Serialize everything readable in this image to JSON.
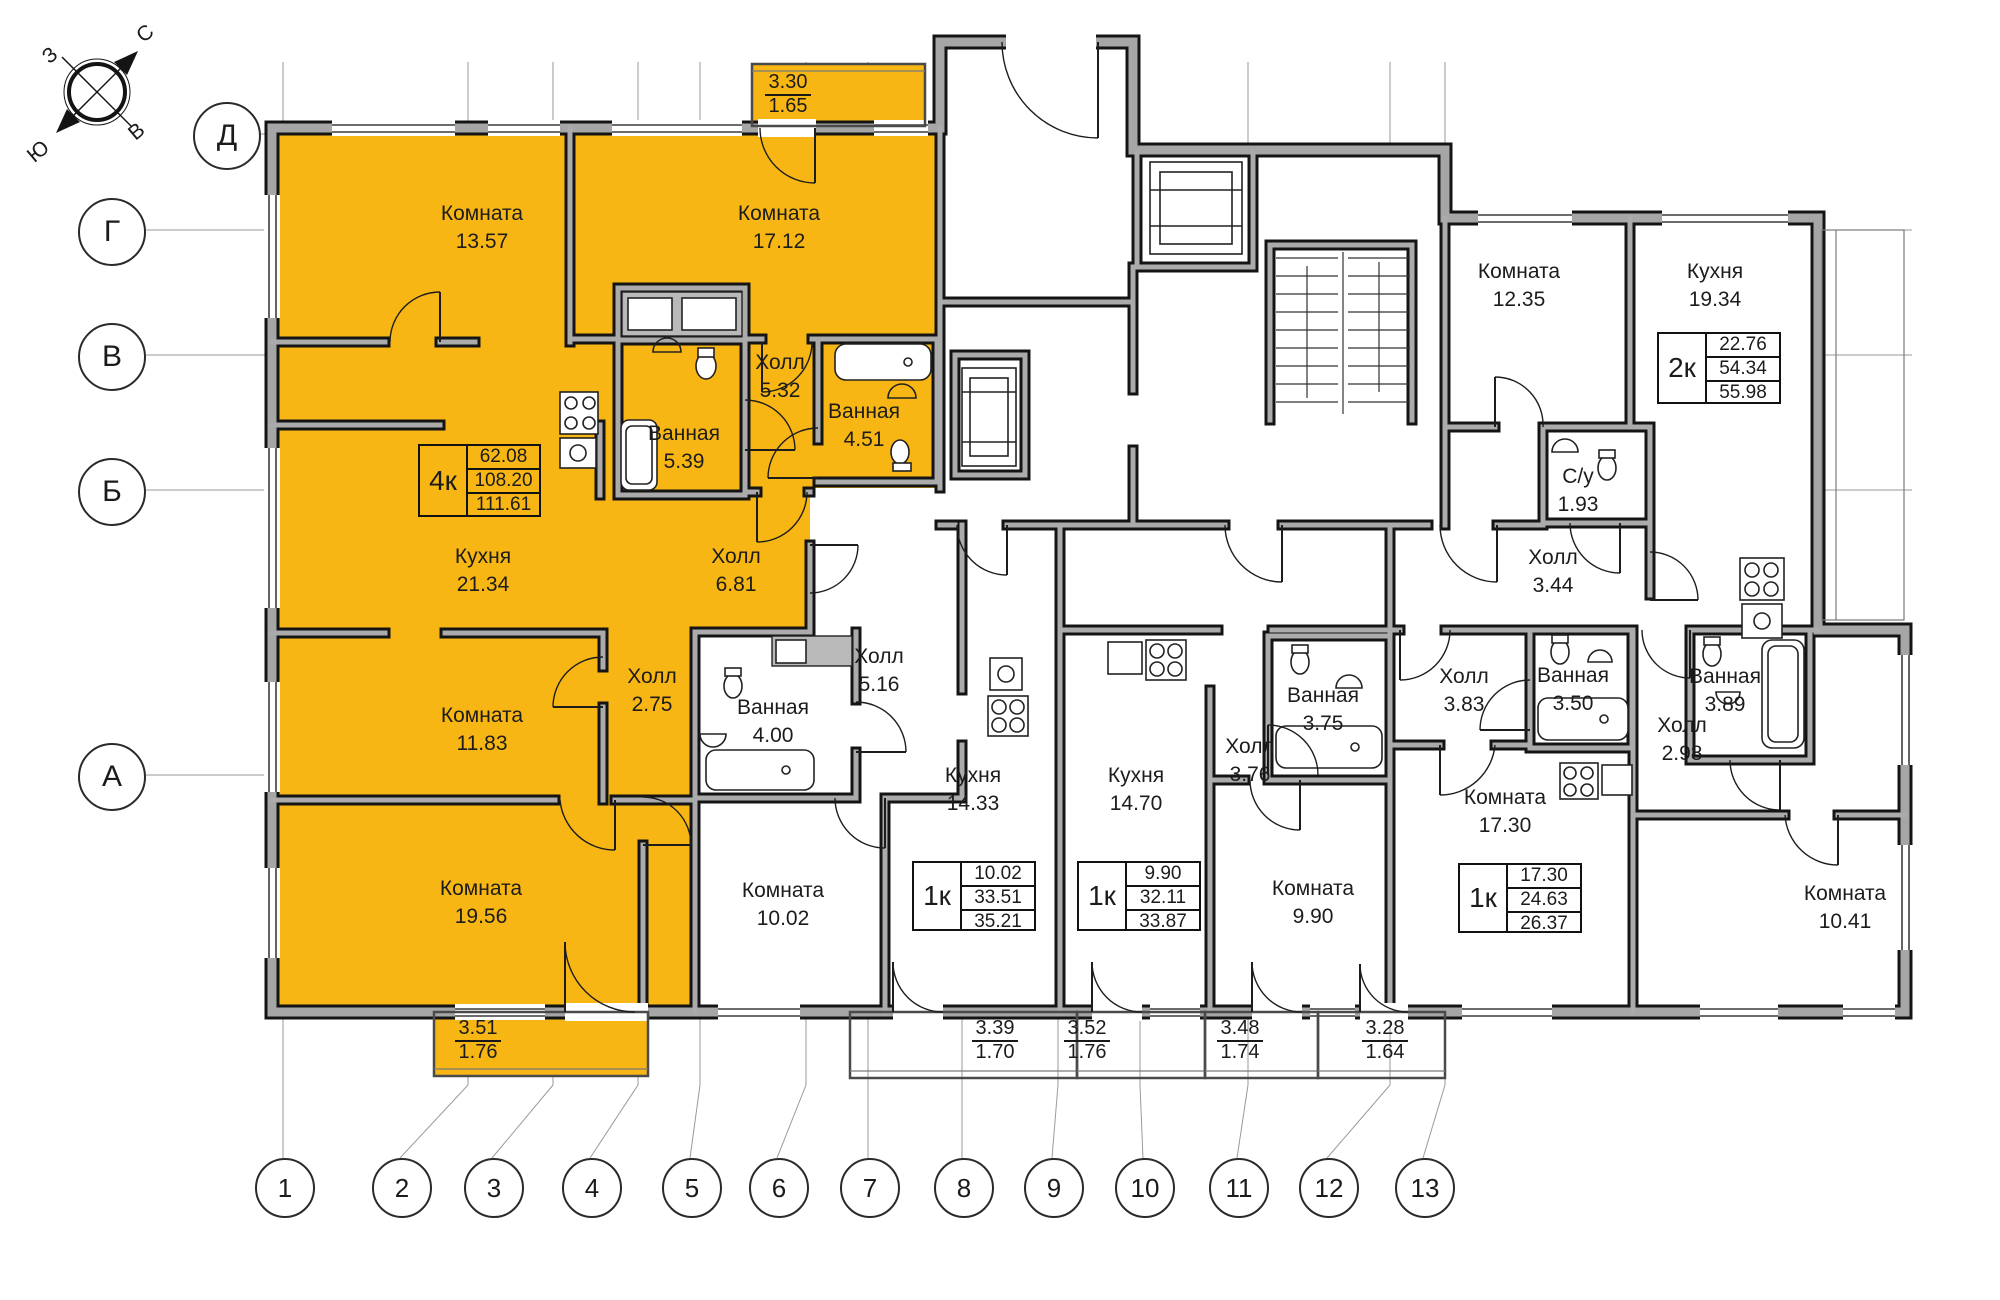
{
  "compass": {
    "north": "С",
    "south": "Ю",
    "west": "З",
    "east": "В"
  },
  "axes": {
    "rows": [
      "Д",
      "Г",
      "В",
      "Б",
      "А"
    ],
    "columns": [
      "1",
      "2",
      "3",
      "4",
      "5",
      "6",
      "7",
      "8",
      "9",
      "10",
      "11",
      "12",
      "13"
    ]
  },
  "rooms": [
    {
      "name": "Комната",
      "area": "13.57"
    },
    {
      "name": "Комната",
      "area": "17.12"
    },
    {
      "name": "Ванная",
      "area": "5.39"
    },
    {
      "name": "Холл",
      "area": "5.32"
    },
    {
      "name": "Ванная",
      "area": "4.51"
    },
    {
      "name": "Кухня",
      "area": "21.34"
    },
    {
      "name": "Холл",
      "area": "6.81"
    },
    {
      "name": "Комната",
      "area": "11.83"
    },
    {
      "name": "Холл",
      "area": "2.75"
    },
    {
      "name": "Комната",
      "area": "19.56"
    },
    {
      "name": "Ванная",
      "area": "4.00"
    },
    {
      "name": "Холл",
      "area": "5.16"
    },
    {
      "name": "Кухня",
      "area": "14.33"
    },
    {
      "name": "Комната",
      "area": "10.02"
    },
    {
      "name": "Кухня",
      "area": "14.70"
    },
    {
      "name": "Холл",
      "area": "3.76"
    },
    {
      "name": "Ванная",
      "area": "3.75"
    },
    {
      "name": "Комната",
      "area": "9.90"
    },
    {
      "name": "Комната",
      "area": "12.35"
    },
    {
      "name": "Кухня",
      "area": "19.34"
    },
    {
      "name": "С/у",
      "area": "1.93"
    },
    {
      "name": "Холл",
      "area": "3.44"
    },
    {
      "name": "Холл",
      "area": "3.83"
    },
    {
      "name": "Ванная",
      "area": "3.50"
    },
    {
      "name": "Комната",
      "area": "17.30"
    },
    {
      "name": "Холл",
      "area": "2.98"
    },
    {
      "name": "Ванная",
      "area": "3.89"
    },
    {
      "name": "Комната",
      "area": "10.41"
    }
  ],
  "apartments": [
    {
      "type": "4к",
      "living": "62.08",
      "total": "108.20",
      "overall": "111.61",
      "highlighted": true
    },
    {
      "type": "1к",
      "living": "10.02",
      "total": "33.51",
      "overall": "35.21",
      "highlighted": false
    },
    {
      "type": "1к",
      "living": "9.90",
      "total": "32.11",
      "overall": "33.87",
      "highlighted": false
    },
    {
      "type": "1к",
      "living": "17.30",
      "total": "24.63",
      "overall": "26.37",
      "highlighted": false
    },
    {
      "type": "2к",
      "living": "22.76",
      "total": "54.34",
      "overall": "55.98",
      "highlighted": false
    }
  ],
  "balconies": [
    {
      "top": "3.30",
      "bottom": "1.65"
    },
    {
      "top": "3.51",
      "bottom": "1.76"
    },
    {
      "top": "3.39",
      "bottom": "1.70"
    },
    {
      "top": "3.52",
      "bottom": "1.76"
    },
    {
      "top": "3.48",
      "bottom": "1.74"
    },
    {
      "top": "3.28",
      "bottom": "1.64"
    }
  ],
  "colors": {
    "highlight": "#F7B614",
    "wall_fill": "#a6a6a6",
    "wall_edge": "#141414"
  }
}
